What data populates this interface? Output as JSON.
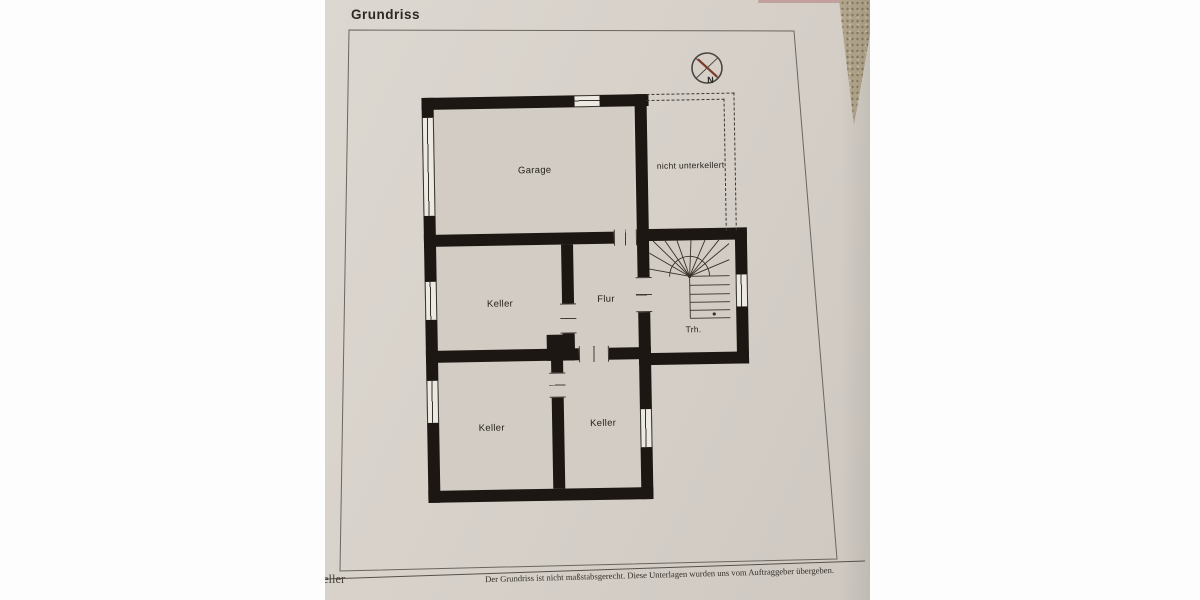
{
  "document": {
    "title": "Grundriss",
    "footer_note": "Der Grundriss ist nicht maßstabsgerecht. Diese Unterlagen wurden uns vom Auftraggeber übergeben.",
    "corner_fragment": "eller"
  },
  "floor_plan": {
    "rooms": {
      "garage": "Garage",
      "keller_middle": "Keller",
      "flur": "Flur",
      "treppenhaus": "Trh.",
      "keller_bottom_left": "Keller",
      "keller_bottom_right": "Keller"
    },
    "annotations": {
      "nicht_unterkellert": "nicht unterkellert"
    },
    "compass": {
      "north_label": "N"
    }
  },
  "colors": {
    "paper": "#d7d1ca",
    "room_fill": "#d3ccc4",
    "wall": "#1c1712",
    "compass_needle": "#7a3b28"
  }
}
